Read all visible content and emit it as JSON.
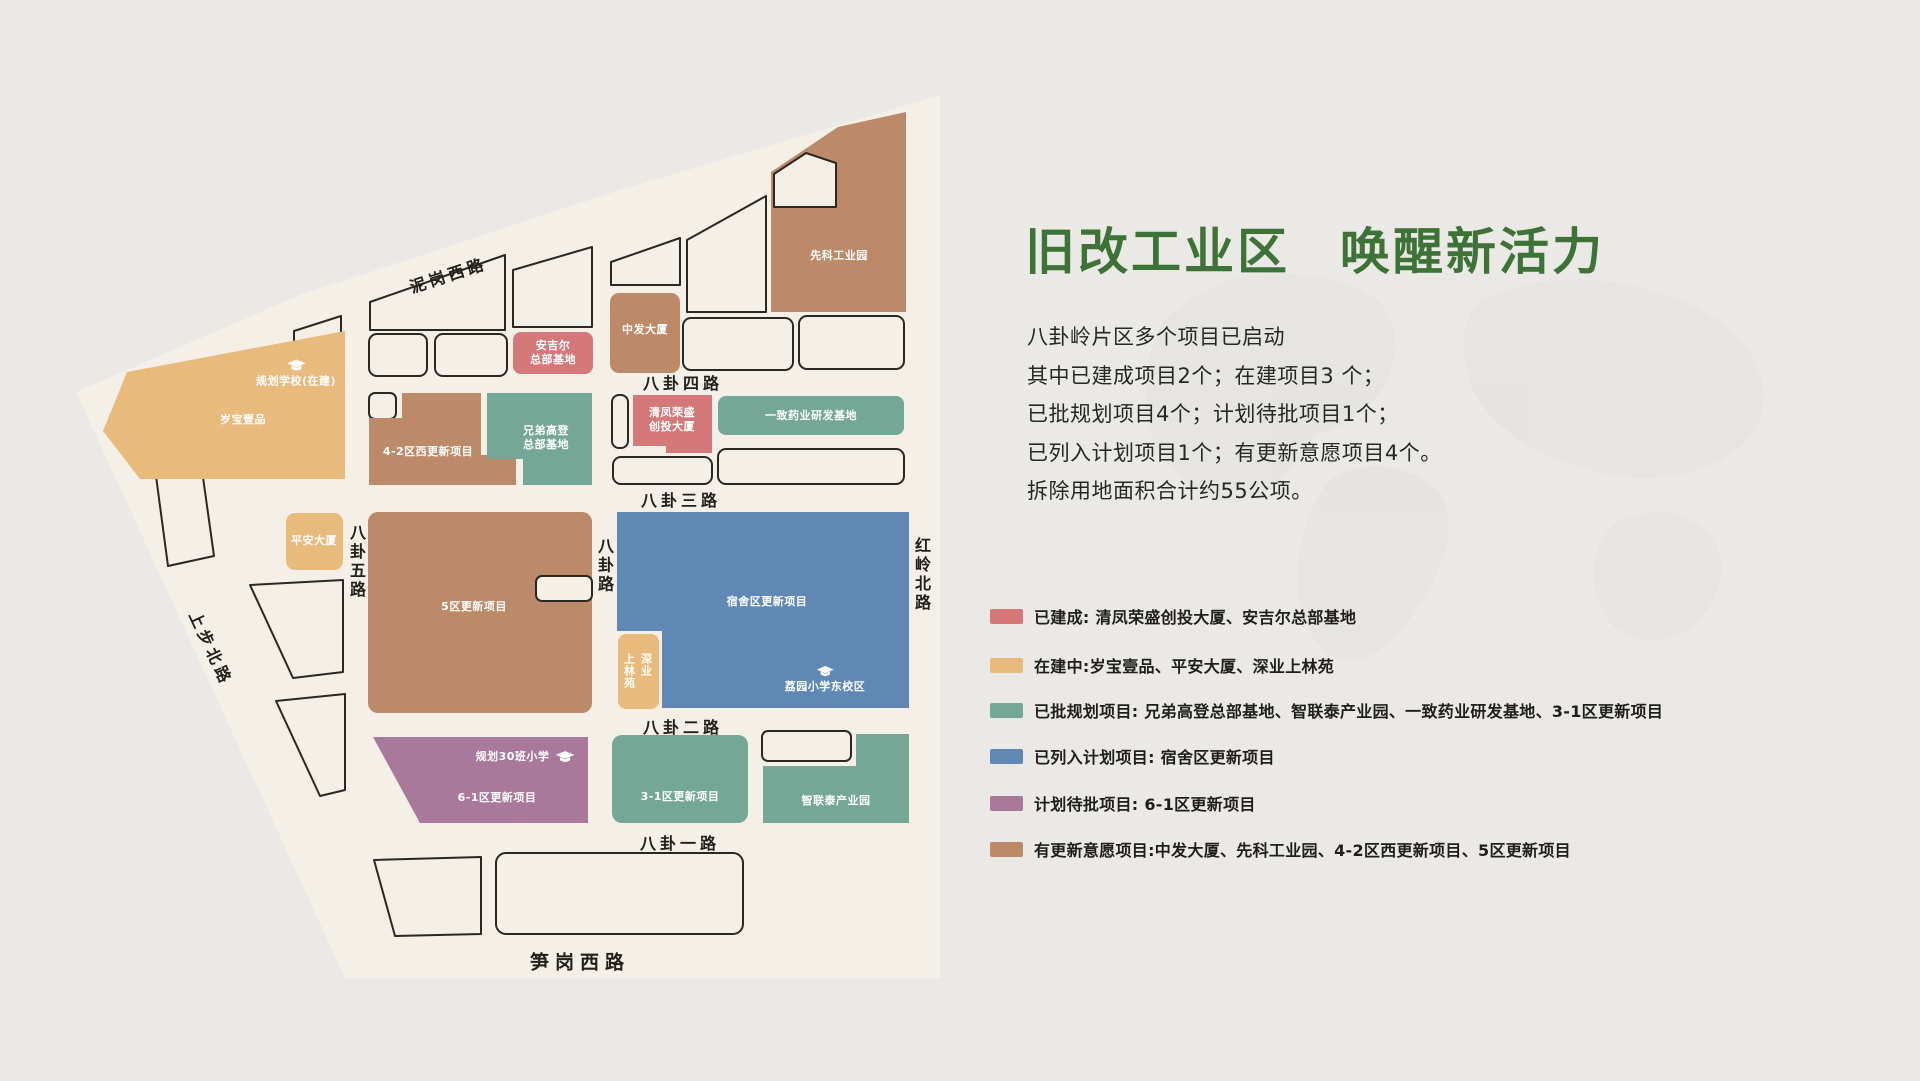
{
  "colors": {
    "built": "#d4787a",
    "under_construction": "#e8bb7d",
    "approved": "#74a796",
    "listed": "#5f88b5",
    "pending": "#a9799b",
    "intent": "#bc8a69",
    "map_bg": "#f4efe7",
    "lot_outline": "#2b2722",
    "title_green": "#3d7336",
    "page_bg": "#eae9e6",
    "watermark": "#e4e3e0"
  },
  "title": {
    "part1": "旧改工业区",
    "part2": "唤醒新活力"
  },
  "intro_lines": [
    "八卦岭片区多个项目已启动",
    "其中已建成项目2个；在建项目3 个；",
    "已批规划项目4个；计划待批项目1个；",
    "已列入计划项目1个；有更新意愿项目4个。",
    "拆除用地面积合计约55公项。"
  ],
  "legend": [
    {
      "color": "#d4787a",
      "label": "已建成: 清凤荣盛创投大厦、安吉尔总部基地"
    },
    {
      "color": "#e8bb7d",
      "label": "在建中:岁宝壹品、平安大厦、深业上林苑"
    },
    {
      "color": "#74a796",
      "label": "已批规划项目: 兄弟高登总部基地、智联泰产业园、一致药业研发基地、3-1区更新项目"
    },
    {
      "color": "#5f88b5",
      "label": "已列入计划项目: 宿舍区更新项目"
    },
    {
      "color": "#a9799b",
      "label": "计划待批项目: 6-1区更新项目"
    },
    {
      "color": "#bc8a69",
      "label": "有更新意愿项目:中发大厦、先科工业园、4-2区西更新项目、5区更新项目"
    }
  ],
  "map": {
    "roads": {
      "nigang_west": "泥岗西路",
      "bagua5": "八卦五路",
      "bagua4": "八卦四路",
      "bagua3": "八卦三路",
      "bagua2": "八卦二路",
      "bagua1": "八卦一路",
      "bagua": "八卦路",
      "shangbu_north": "上步北路",
      "hongling_north": "红岭北路",
      "sungang_west": "笋岗西路"
    },
    "blocks": {
      "suibao": "岁宝壹品",
      "school_planned": "规划学校(在建)",
      "pingan": "平安大厦",
      "anjier_line1": "安吉尔",
      "anjier_line2": "总部基地",
      "zhongfa": "中发大厦",
      "xianke": "先科工业园",
      "qu42": "4-2区西更新项目",
      "xiongdi_line1": "兄弟高登",
      "xiongdi_line2": "总部基地",
      "qingfeng_line1": "清凤荣盛",
      "qingfeng_line2": "创投大厦",
      "yizhi": "一致药业研发基地",
      "qu5": "5区更新项目",
      "sushe": "宿舍区更新项目",
      "shenye_col_left": "上林苑",
      "shenye_col_right": "深业",
      "liyuan": "荔园小学东校区",
      "qu61": "6-1区更新项目",
      "school30": "规划30班小学",
      "qu31": "3-1区更新项目",
      "zhiliantai": "智联泰产业园"
    }
  }
}
